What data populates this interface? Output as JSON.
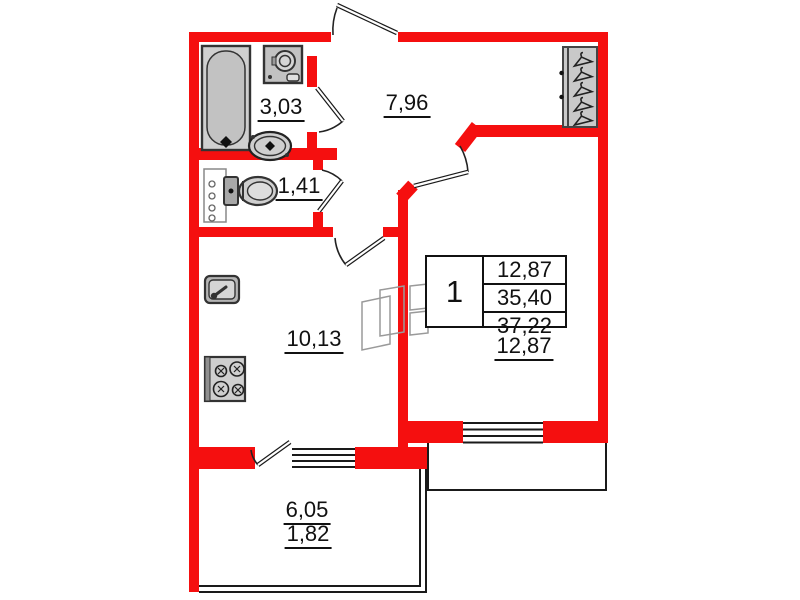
{
  "areas": {
    "bathroom": "3,03",
    "hallway": "7,96",
    "wc": "1,41",
    "kitchen": "10,13",
    "living_room": "12,87",
    "balcony_total": "6,05",
    "balcony_reduced": "1,82"
  },
  "summary_table": {
    "rooms": "1",
    "living_area": "12,87",
    "apartment_area": "35,40",
    "total_area": "37,22"
  },
  "colors": {
    "wall_red": "#f50f0f",
    "line_black": "#1a1a1a",
    "fixture_gray": "#cfcfcf",
    "background": "#ffffff"
  },
  "icons": {
    "bathtub-icon": "rounded-rect tub with drain diamond",
    "washing-machine-icon": "square with drum circle",
    "washbasin-icon": "oval sink with drain diamond",
    "toilet-icon": "tank rectangle with oval bowl",
    "plumbing-riser-icon": "rectangle with four circles",
    "kitchen-sink-icon": "square sink with faucet",
    "stove-icon": "square with four burner circles",
    "wardrobe-hangers-icon": "closet with five coat hangers",
    "ventilation-shaft-icon": "skewed duct rectangles",
    "door-swing-icon": "leaf line with quarter arc",
    "window-icon": "four parallel glazing lines"
  }
}
